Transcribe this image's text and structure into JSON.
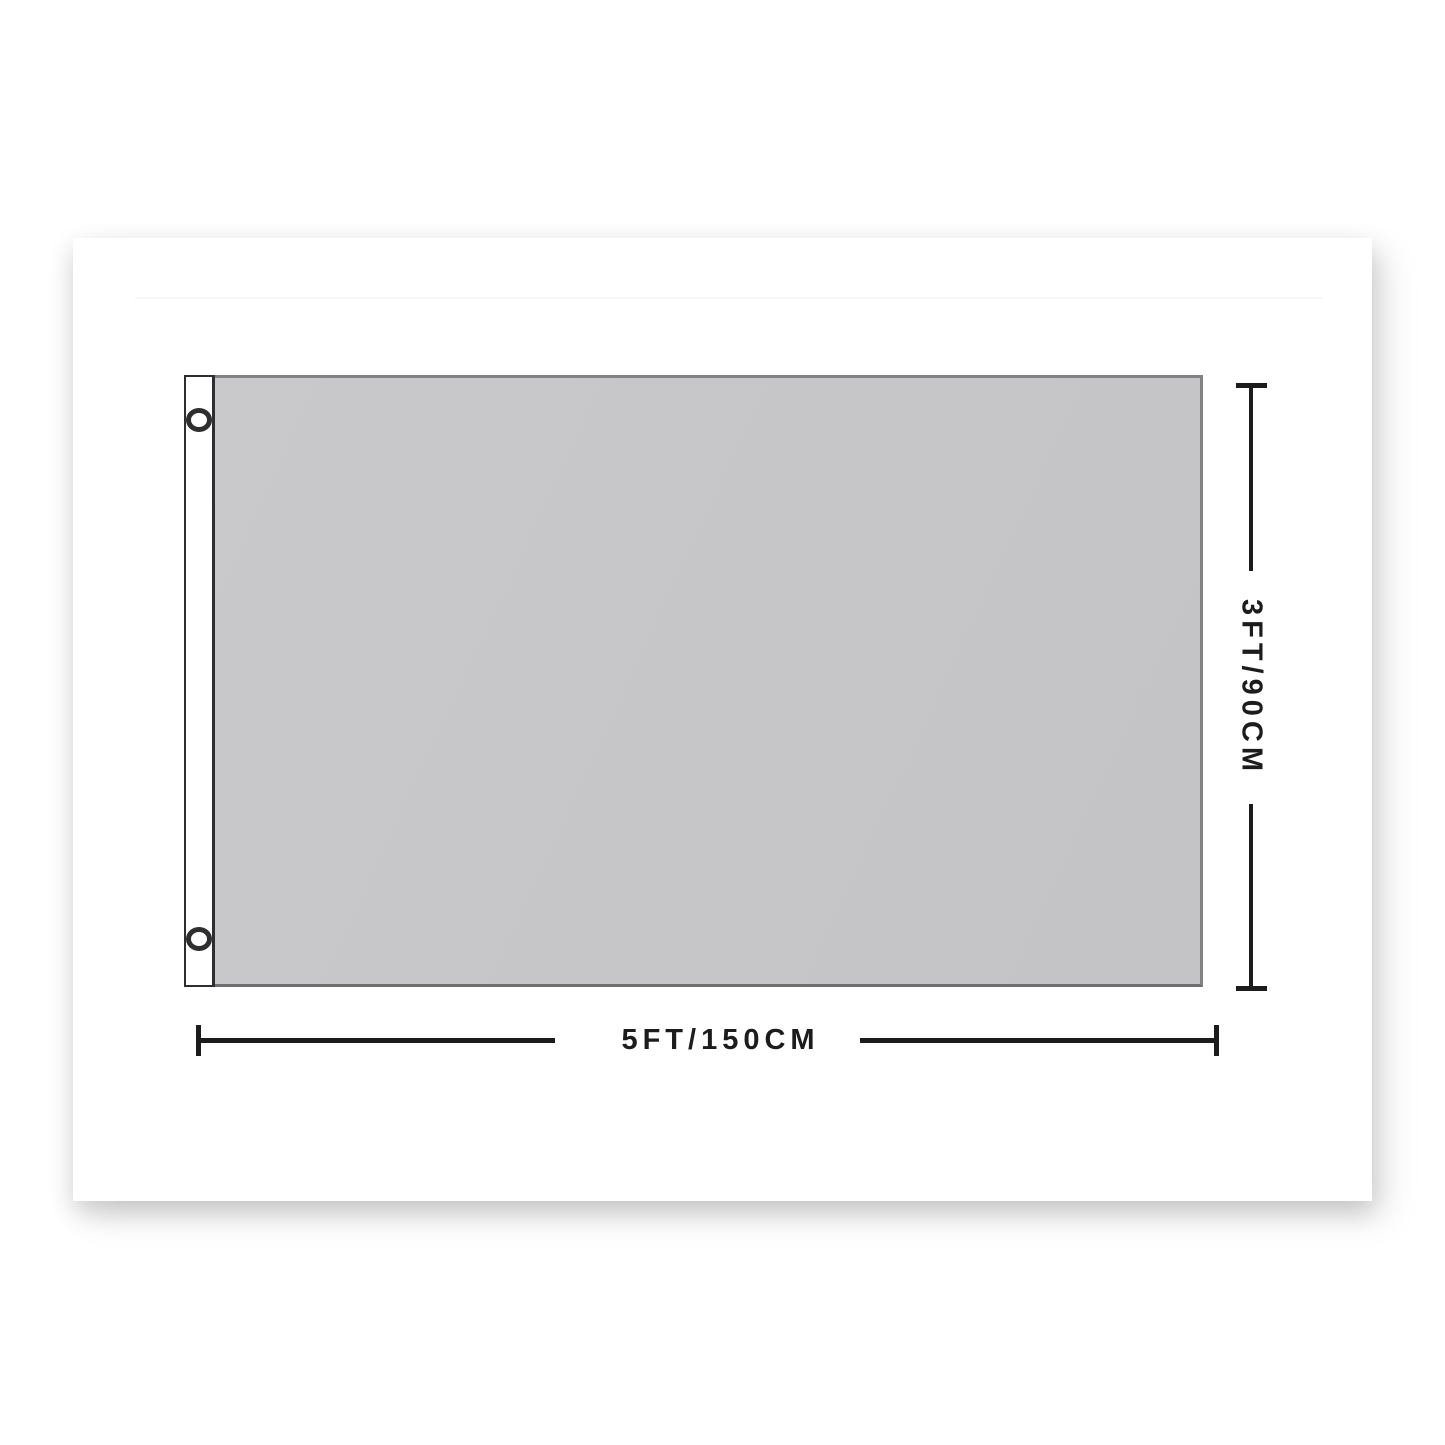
{
  "image": {
    "type": "flag-size-dimension-diagram",
    "background_color": "#ffffff",
    "card_background": "#ffffff"
  },
  "flag": {
    "body_color": "#c6c6c8",
    "body_border_color": "#828285",
    "sleeve_color": "#ffffff",
    "sleeve_outline_color": "#2e2e2e",
    "grommet_count": 2,
    "grommet_fill_color": "#ffffff",
    "grommet_ring_color": "#2e2e2e"
  },
  "dimensions": {
    "width_label": "5FT/150CM",
    "height_label": "3FT/90CM",
    "line_color": "#1c1c1c",
    "text_color": "#1c1c1c"
  }
}
